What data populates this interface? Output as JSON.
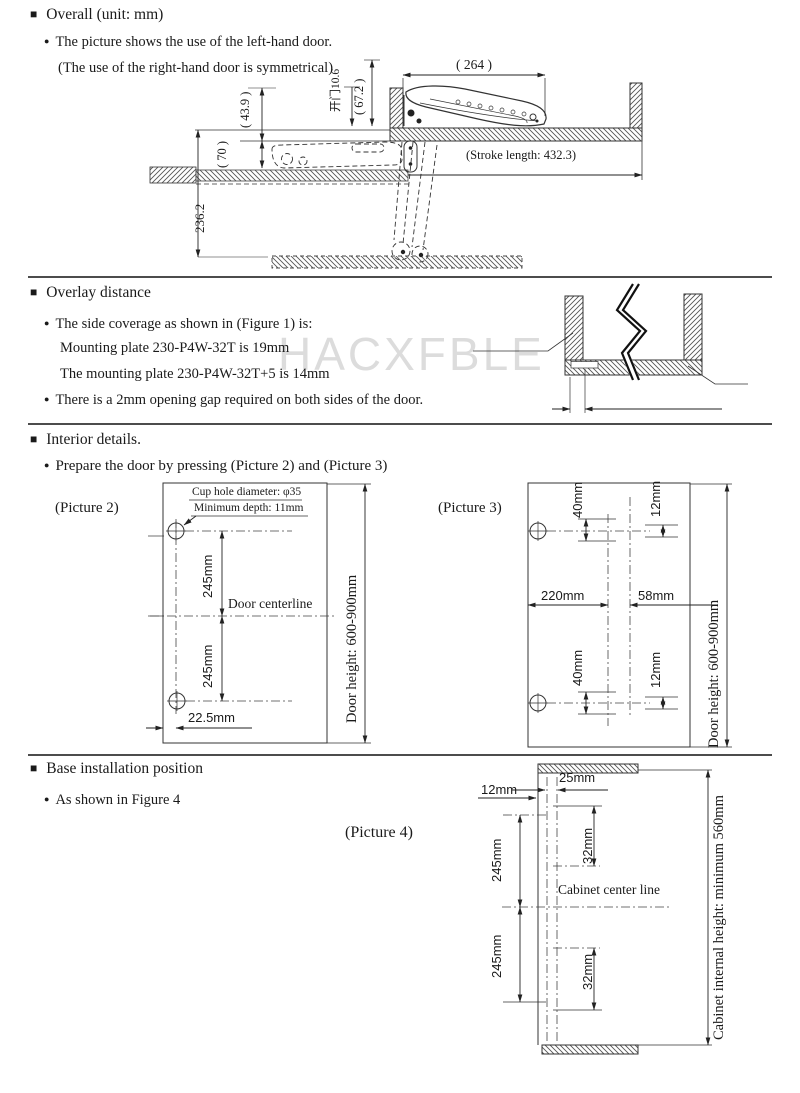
{
  "page": {
    "watermark": "HACXFBLE"
  },
  "icons": {
    "section_marker": "■",
    "bullet": "●"
  },
  "section1": {
    "title": "Overall (unit: mm)",
    "bullet1": "The picture shows the use of the left-hand door.",
    "bullet2": "(The use of the right-hand door is symmetrical)",
    "drawing": {
      "dim_width_top": "( 264 )",
      "dim_67_2": "( 67.2 )",
      "dim_opening": "开门10.6",
      "dim_43_9": "( 43.9 )",
      "dim_70": "( 70 )",
      "dim_236_2": "236.2",
      "stroke_length": "(Stroke length: 432.3)"
    }
  },
  "section2": {
    "title": "Overlay distance",
    "bullet1_line1": "The side coverage as shown in (Figure 1) is:",
    "bullet1_line2": "Mounting plate 230-P4W-32T is 19mm",
    "bullet1_line3": "The mounting plate 230-P4W-32T+5 is 14mm",
    "bullet2": "There is a 2mm opening gap required on both sides of the door."
  },
  "section3": {
    "title": "Interior details.",
    "bullet1": "Prepare the door by pressing (Picture 2) and (Picture 3)",
    "picture2": {
      "label": "(Picture 2)",
      "cup_hole_note": "Cup hole diameter: φ35",
      "depth_note": "Minimum depth: 11mm",
      "dim_245_top": "245mm",
      "centerline_label": "Door centerline",
      "dim_245_bottom": "245mm",
      "dim_edge": "22.5mm",
      "door_height": "Door height: 600-900mm"
    },
    "picture3": {
      "label": "(Picture 3)",
      "dim_40_top": "40mm",
      "dim_12_top": "12mm",
      "dim_220": "220mm",
      "dim_58": "58mm",
      "dim_40_bottom": "40mm",
      "dim_12_bottom": "12mm",
      "door_height": "Door height: 600-900mm"
    }
  },
  "section4": {
    "title": "Base installation position",
    "bullet1": "As shown in Figure 4",
    "picture4": {
      "label": "(Picture 4)",
      "dim_12": "12mm",
      "dim_25": "25mm",
      "dim_245_top": "245mm",
      "dim_32_top": "32mm",
      "centerline_label": "Cabinet center line",
      "dim_245_bottom": "245mm",
      "dim_32_bottom": "32mm",
      "internal_height": "Cabinet internal height: minimum 560mm"
    }
  }
}
